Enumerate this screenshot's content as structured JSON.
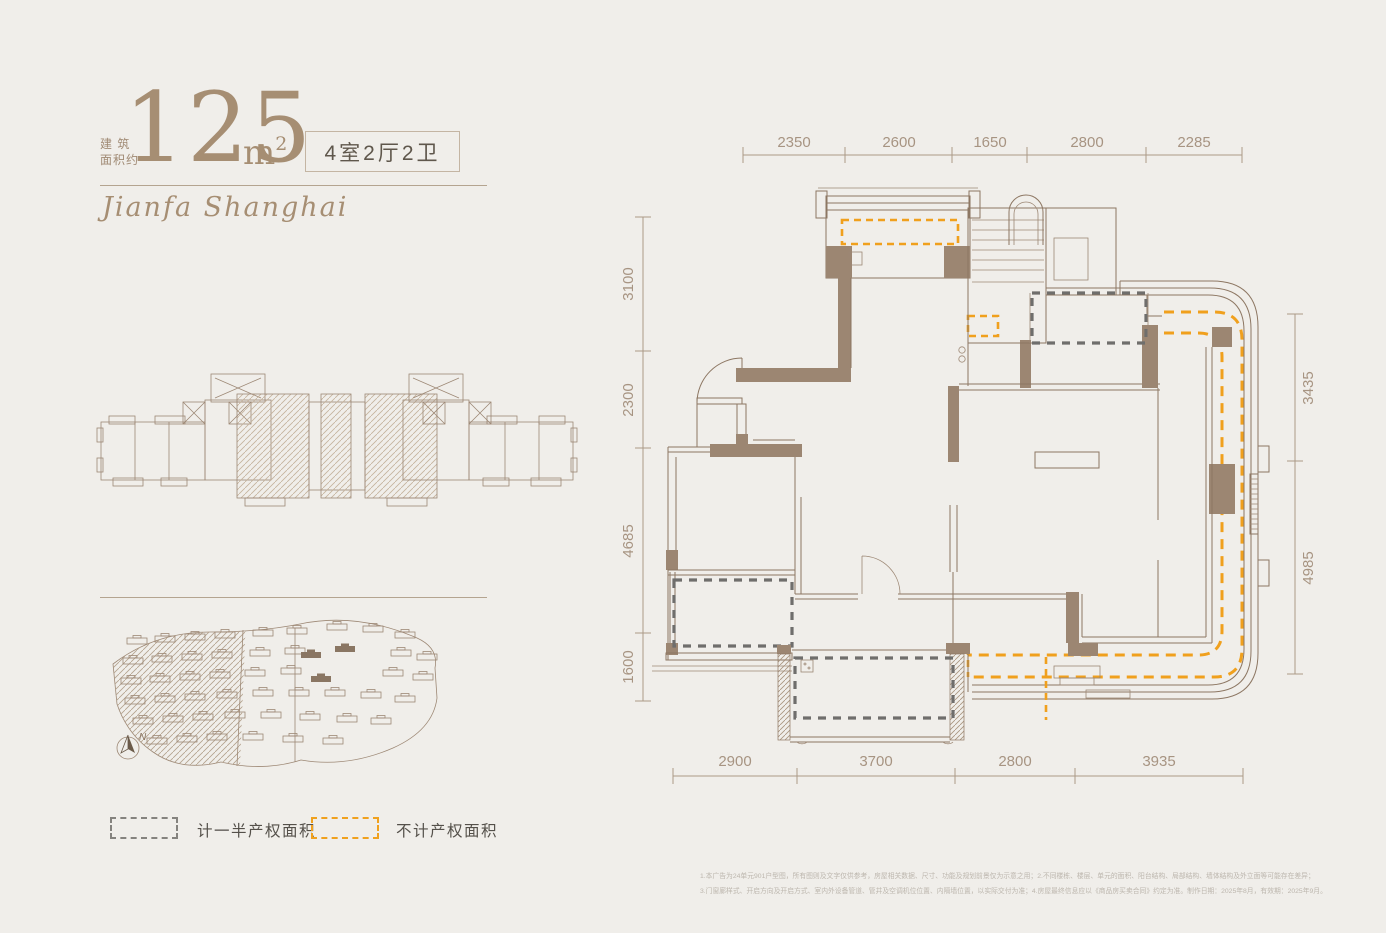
{
  "header": {
    "area_label_line1": "建 筑",
    "area_label_line2": "面积约",
    "area_value": "125",
    "area_unit": "m",
    "area_unit_exp": "2",
    "unit_tag": "4室2厅2卫",
    "brand_script": "Jianfa Shanghai"
  },
  "floorplan": {
    "dims": {
      "top": [
        "2350",
        "2600",
        "1650",
        "2800",
        "2285"
      ],
      "left": [
        "3100",
        "2300",
        "4685",
        "1600"
      ],
      "right": [
        "3435",
        "4985"
      ],
      "bottom": [
        "2900",
        "3700",
        "2800",
        "3935"
      ]
    }
  },
  "site_map": {
    "north_label": "N"
  },
  "legend": {
    "half_property": "计一半产权面积",
    "no_property": "不计产权面积"
  },
  "disclaimer": {
    "line1": "1.本广告为24单元901户型图，所有图则及文字仅供参考，房屋相关数据、尺寸、功能及规划前景仅为示意之用；2.不同楼栋、楼层、单元的面积、阳台结构、局部结构、墙体结构及外立面等可能存在差异；",
    "line2": "3.门窗廊样式、开启方向及开启方式、室内外设备管道、管井及空调机位位置、内隔墙位置，以实际交付为准；4.房屋最终信息应以《商品房买卖合同》约定为准。制作日期：2025年8月，有效期：2025年9月。"
  },
  "colors": {
    "background": "#f0eeea",
    "accent_brown": "#a68e73",
    "wall_brown": "#9c8672",
    "accent_orange": "#f0a11e",
    "dash_gray": "#6f6e6c"
  }
}
